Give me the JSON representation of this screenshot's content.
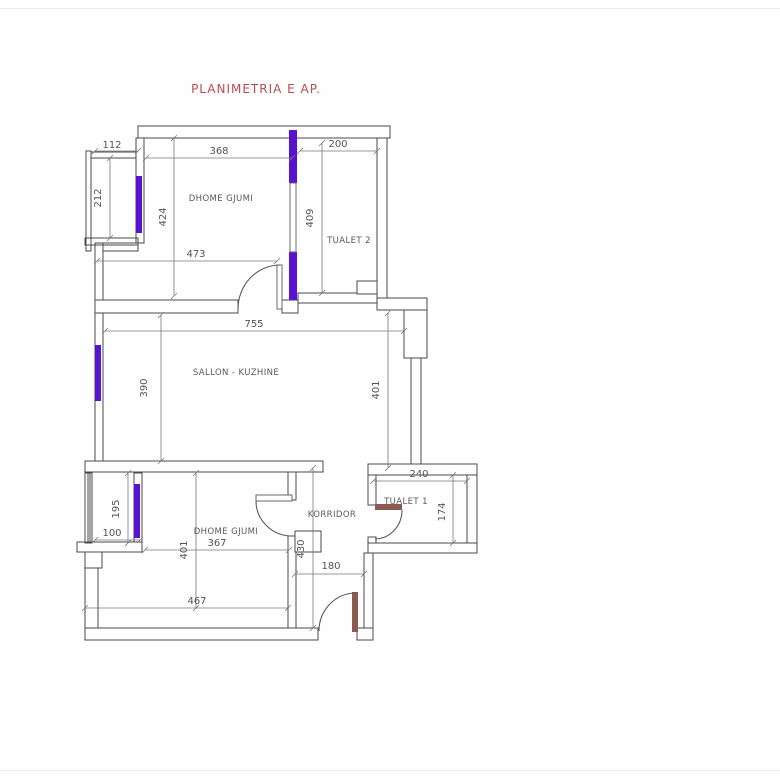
{
  "title": "PLANIMETRIA E AP.",
  "colors": {
    "window": "#5912cf",
    "title": "#b84a4f",
    "wall": "#4a4a4a",
    "dimension_text": "#555555",
    "door_leaf": "#8a5a50"
  },
  "rooms": {
    "bedroom1": "DHOME GJUMI",
    "tualet2": "TUALET 2",
    "sallon": "SALLON - KUZHINE",
    "bedroom2": "DHOME GJUMI",
    "korridor": "KORRIDOR",
    "tualet1": "TUALET 1"
  },
  "dims": {
    "balcony1_w": "112",
    "balcony1_h": "212",
    "bed1_top": "368",
    "bed1_h": "424",
    "bed1_bottom": "473",
    "t2_w": "200",
    "t2_h": "409",
    "sallon_w": "755",
    "sallon_left_h": "390",
    "sallon_right_h": "401",
    "balcony2_h": "195",
    "balcony2_w": "100",
    "bed2_top": "367",
    "bed2_h": "401",
    "bed2_bottom": "467",
    "t1_w": "240",
    "t1_h": "174",
    "korridor_h": "430",
    "entry_w": "180"
  }
}
